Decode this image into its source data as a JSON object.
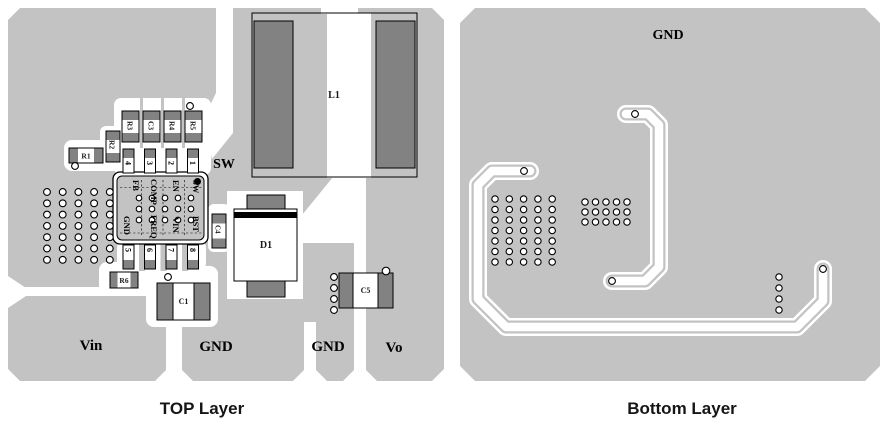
{
  "titles": {
    "top": "TOP Layer",
    "bottom": "Bottom Layer"
  },
  "colors": {
    "copper": "#c3c3c3",
    "pad_gray": "#828282",
    "outline": "#000000",
    "clearance": "#ffffff"
  },
  "top_layer": {
    "net_labels": {
      "sw": "SW",
      "vin": "Vin",
      "gnd_mid": "GND",
      "gnd_right": "GND",
      "vo": "Vo"
    },
    "components": {
      "r1": "R1",
      "r2": "R2",
      "r3": "R3",
      "c3": "C3",
      "r4": "R4",
      "r5": "R5",
      "r6": "R6",
      "c1": "C1",
      "c4": "C4",
      "c5": "C5",
      "d1": "D1",
      "l1": "L1"
    },
    "ic": {
      "pin_names_top": [
        "FB",
        "COMP",
        "EN",
        "SW"
      ],
      "pin_names_bottom": [
        "GND",
        "FREQ",
        "VIN",
        "BST"
      ],
      "pad_numbers_top": [
        "4",
        "3",
        "2",
        "1"
      ],
      "pad_numbers_bottom": [
        "5",
        "6",
        "7",
        "8"
      ]
    }
  },
  "bottom_layer": {
    "net_labels": {
      "gnd": "GND"
    }
  },
  "via_grids": [
    {
      "target": "vg-top-left",
      "x0": 47,
      "y0": 192,
      "dx": 15.7,
      "dy": 11.3,
      "cols": 5,
      "rows": 7,
      "r": 3.4
    },
    {
      "target": "vg-ic",
      "x0": 139,
      "y0": 198,
      "dx": 13,
      "dy": 11,
      "cols": 5,
      "rows": 3,
      "r": 2.8
    },
    {
      "target": "vg-c5",
      "x0": 334,
      "y0": 277,
      "dx": 0,
      "dy": 11,
      "cols": 1,
      "rows": 4,
      "r": 3.4
    },
    {
      "target": "vg-bl-left",
      "x0": 495,
      "y0": 199,
      "dx": 14.3,
      "dy": 10.5,
      "cols": 5,
      "rows": 7,
      "r": 3.2
    },
    {
      "target": "vg-bl-mid",
      "x0": 585,
      "y0": 202,
      "dx": 10.5,
      "dy": 10,
      "cols": 5,
      "rows": 3,
      "r": 3.2
    },
    {
      "target": "vg-bl-right",
      "x0": 779,
      "y0": 277,
      "dx": 0,
      "dy": 11,
      "cols": 1,
      "rows": 4,
      "r": 3.2
    }
  ],
  "vias": [
    [
      75,
      166,
      3.4
    ],
    [
      190,
      106,
      3.4
    ],
    [
      168,
      277,
      3.4
    ],
    [
      386,
      271,
      3.8
    ],
    [
      524,
      171,
      3.4
    ],
    [
      635,
      114,
      3.4
    ],
    [
      612,
      281,
      3.4
    ],
    [
      823,
      269,
      3.4
    ]
  ]
}
